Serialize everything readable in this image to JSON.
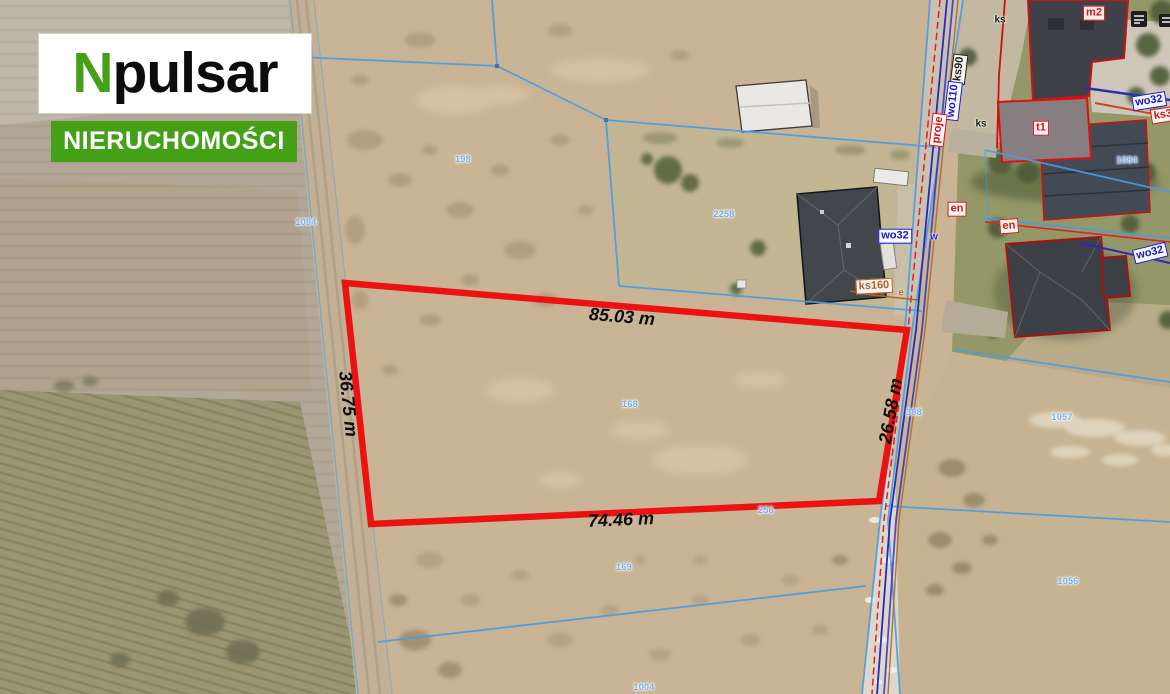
{
  "brand": {
    "prefix": "N",
    "name": "pulsar",
    "tagline": "NIERUCHOMOŚCI"
  },
  "colors": {
    "brand_green": "#44a117",
    "plot_outline": "#ec1212",
    "cadastral_blue": "#4a9ce2"
  },
  "measurements": {
    "top": "85.03 m",
    "bottom": "74.46 m",
    "left": "36.75 m",
    "right": "26.58 m"
  },
  "map_annotations": {
    "parcel_numbers": [
      {
        "text": "198",
        "x": 463,
        "y": 159
      },
      {
        "text": "2258",
        "x": 724,
        "y": 214
      },
      {
        "text": "168",
        "x": 630,
        "y": 404
      },
      {
        "text": "1094",
        "x": 306,
        "y": 222
      },
      {
        "text": "388",
        "x": 914,
        "y": 412
      },
      {
        "text": "256",
        "x": 766,
        "y": 510
      },
      {
        "text": "169",
        "x": 624,
        "y": 567
      },
      {
        "text": "1004",
        "x": 644,
        "y": 687
      },
      {
        "text": "1084",
        "x": 1127,
        "y": 160
      },
      {
        "text": "1057",
        "x": 1062,
        "y": 417
      },
      {
        "text": "1056",
        "x": 1068,
        "y": 581
      }
    ],
    "utility_labels": [
      {
        "text": "ks90",
        "x": 959,
        "y": 69,
        "rot": -83,
        "color": "#1a1a1a"
      },
      {
        "text": "wo110",
        "x": 953,
        "y": 101,
        "rot": -83,
        "color": "#1616cc"
      },
      {
        "text": "proje",
        "x": 938,
        "y": 130,
        "rot": -83,
        "color": "#dd1111"
      },
      {
        "text": "ks",
        "x": 1000,
        "y": 20,
        "rot": 0,
        "color": "#1a1a1a",
        "box": false
      },
      {
        "text": "ks",
        "x": 981,
        "y": 124,
        "rot": 0,
        "color": "#1a1a1a",
        "box": false
      },
      {
        "text": "m2",
        "x": 1094,
        "y": 13,
        "rot": 0,
        "color": "#dd1111"
      },
      {
        "text": "t1",
        "x": 1041,
        "y": 128,
        "rot": 0,
        "color": "#dd1111"
      },
      {
        "text": "en",
        "x": 1009,
        "y": 226,
        "rot": -4,
        "color": "#dd1111"
      },
      {
        "text": "en",
        "x": 957,
        "y": 209,
        "rot": 0,
        "color": "#dd1111"
      },
      {
        "text": "wo32",
        "x": 895,
        "y": 236,
        "rot": 0,
        "color": "#1616cc"
      },
      {
        "text": "w",
        "x": 934,
        "y": 237,
        "rot": 0,
        "color": "#2a2ad0",
        "box": false
      },
      {
        "text": "ks160",
        "x": 874,
        "y": 286,
        "rot": -3,
        "color": "#b5651d"
      },
      {
        "text": "e",
        "x": 901,
        "y": 293,
        "rot": 0,
        "color": "#c06515",
        "box": false
      },
      {
        "text": "wo32",
        "x": 1150,
        "y": 253,
        "rot": -14,
        "color": "#1616cc"
      },
      {
        "text": "wo32",
        "x": 1149,
        "y": 101,
        "rot": -9,
        "color": "#1616cc"
      },
      {
        "text": "ks3",
        "x": 1163,
        "y": 115,
        "rot": -9,
        "color": "#dd1111"
      }
    ]
  }
}
